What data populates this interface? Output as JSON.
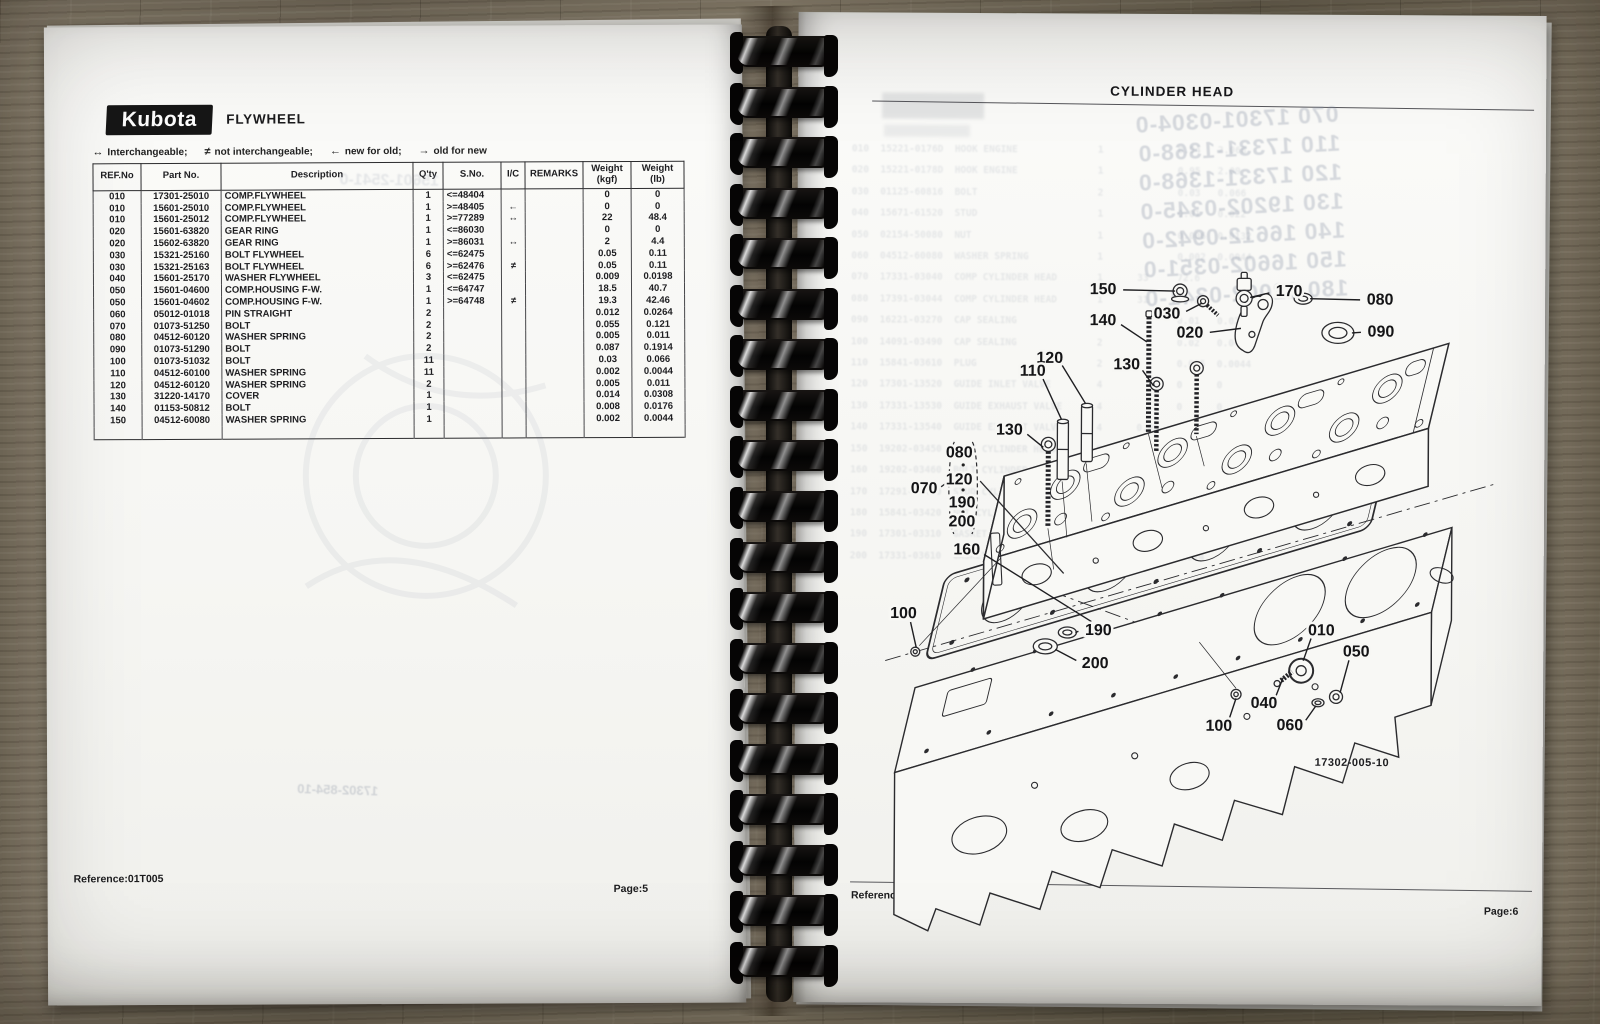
{
  "left_page": {
    "brand_logo": "Kubota",
    "section_title": "FLYWHEEL",
    "legend": [
      {
        "symbol": "↔",
        "label": "Interchangeable;"
      },
      {
        "symbol": "≠",
        "label": "not interchangeable;"
      },
      {
        "symbol": "←",
        "label": "new for old;"
      },
      {
        "symbol": "→",
        "label": "old for new"
      }
    ],
    "table": {
      "headers": [
        "REF.No",
        "Part No.",
        "Description",
        "Q'ty",
        "S.No.",
        "I/C",
        "REMARKS",
        "Weight\n(kgf)",
        "Weight\n(lb)"
      ],
      "rows": [
        [
          "010",
          "17301-25010",
          "COMP.FLYWHEEL",
          "1",
          "<=48404",
          "",
          "",
          "0",
          "0"
        ],
        [
          "010",
          "15601-25010",
          "COMP.FLYWHEEL",
          "1",
          ">=48405",
          "←",
          "",
          "0",
          "0"
        ],
        [
          "010",
          "15601-25012",
          "COMP.FLYWHEEL",
          "1",
          ">=77289",
          "↔",
          "",
          "22",
          "48.4"
        ],
        [
          "020",
          "15601-63820",
          "GEAR RING",
          "1",
          "<=86030",
          "",
          "",
          "0",
          "0"
        ],
        [
          "020",
          "15602-63820",
          "GEAR RING",
          "1",
          ">=86031",
          "↔",
          "",
          "2",
          "4.4"
        ],
        [
          "030",
          "15321-25160",
          "BOLT FLYWHEEL",
          "6",
          "<=62475",
          "",
          "",
          "0.05",
          "0.11"
        ],
        [
          "030",
          "15321-25163",
          "BOLT FLYWHEEL",
          "6",
          ">=62476",
          "≠",
          "",
          "0.05",
          "0.11"
        ],
        [
          "040",
          "15601-25170",
          "WASHER FLYWHEEL",
          "3",
          "<=62475",
          "",
          "",
          "0.009",
          "0.0198"
        ],
        [
          "050",
          "15601-04600",
          "COMP.HOUSING F-W.",
          "1",
          "<=64747",
          "",
          "",
          "18.5",
          "40.7"
        ],
        [
          "050",
          "15601-04602",
          "COMP.HOUSING F-W.",
          "1",
          ">=64748",
          "≠",
          "",
          "19.3",
          "42.46"
        ],
        [
          "060",
          "05012-01018",
          "PIN STRAIGHT",
          "2",
          "",
          "",
          "",
          "0.012",
          "0.0264"
        ],
        [
          "070",
          "01073-51250",
          "BOLT",
          "2",
          "",
          "",
          "",
          "0.055",
          "0.121"
        ],
        [
          "080",
          "04512-60120",
          "WASHER SPRING",
          "2",
          "",
          "",
          "",
          "0.005",
          "0.011"
        ],
        [
          "090",
          "01073-51290",
          "BOLT",
          "2",
          "",
          "",
          "",
          "0.087",
          "0.1914"
        ],
        [
          "100",
          "01073-51032",
          "BOLT",
          "11",
          "",
          "",
          "",
          "0.03",
          "0.066"
        ],
        [
          "110",
          "04512-60100",
          "WASHER SPRING",
          "11",
          "",
          "",
          "",
          "0.002",
          "0.0044"
        ],
        [
          "120",
          "04512-60120",
          "WASHER SPRING",
          "2",
          "",
          "",
          "",
          "0.005",
          "0.011"
        ],
        [
          "130",
          "31220-14170",
          "COVER",
          "1",
          "",
          "",
          "",
          "0.014",
          "0.0308"
        ],
        [
          "140",
          "01153-50812",
          "BOLT",
          "1",
          "",
          "",
          "",
          "0.008",
          "0.0176"
        ],
        [
          "150",
          "04512-60080",
          "WASHER SPRING",
          "1",
          "",
          "",
          "",
          "0.002",
          "0.0044"
        ]
      ]
    },
    "footer": {
      "reference": "Reference:01T005",
      "page": "Page:5"
    },
    "bleed_through": {
      "figure_ghost": "17302-854-10",
      "parts_ghost": "15601-2541-0"
    }
  },
  "right_page": {
    "title": "CYLINDER HEAD",
    "diagram": {
      "figure_id": "17302-005-10",
      "callouts": [
        {
          "label": "150",
          "x": 306,
          "y": 276,
          "ex": 378,
          "ey": 277
        },
        {
          "label": "140",
          "x": 306,
          "y": 307,
          "ex": 350,
          "ey": 328
        },
        {
          "label": "030",
          "x": 370,
          "y": 300,
          "ex": 405,
          "ey": 289
        },
        {
          "label": "020",
          "x": 393,
          "y": 319,
          "ex": 444,
          "ey": 314
        },
        {
          "label": "170",
          "x": 492,
          "y": 277,
          "ex": 453,
          "ey": 283
        },
        {
          "label": "080",
          "x": 583,
          "y": 285,
          "ex": 513,
          "ey": 284
        },
        {
          "label": "090",
          "x": 584,
          "y": 317,
          "ex": 555,
          "ey": 318
        },
        {
          "label": "120",
          "x": 253,
          "y": 345,
          "ex": 289,
          "ey": 390
        },
        {
          "label": "110",
          "x": 236,
          "y": 358,
          "ex": 265,
          "ey": 406
        },
        {
          "label": "130",
          "x": 330,
          "y": 351,
          "ex": 357,
          "ey": 372
        },
        {
          "label": "130",
          "x": 213,
          "y": 417,
          "ex": 247,
          "ey": 434
        },
        {
          "label": "160",
          "x": 171,
          "y": 537,
          "ex": 296,
          "ey": 608
        },
        {
          "label": "100",
          "x": 108,
          "y": 601,
          "ex": 121,
          "ey": 635
        },
        {
          "label": "190",
          "x": 303,
          "y": 617,
          "ex": 280,
          "ey": 619
        },
        {
          "label": "200",
          "x": 300,
          "y": 650,
          "ex": 260,
          "ey": 636
        },
        {
          "label": "010",
          "x": 526,
          "y": 616,
          "ex": 508,
          "ey": 646
        },
        {
          "label": "050",
          "x": 561,
          "y": 637,
          "ex": 545,
          "ey": 678
        },
        {
          "label": "040",
          "x": 469,
          "y": 689,
          "ex": 488,
          "ey": 663
        },
        {
          "label": "100",
          "x": 424,
          "y": 712,
          "ex": 441,
          "ey": 684
        },
        {
          "label": "060",
          "x": 495,
          "y": 711,
          "ex": 521,
          "ey": 691
        }
      ],
      "callout_group": {
        "pointer_label": "070",
        "pointer_x": 128,
        "pointer_y": 476,
        "items": [
          {
            "label": "080",
            "x": 163,
            "y": 440
          },
          {
            "label": "120",
            "x": 163,
            "y": 467
          },
          {
            "label": "190",
            "x": 166,
            "y": 490
          },
          {
            "label": "200",
            "x": 166,
            "y": 509
          }
        ]
      }
    },
    "bleed_through": {
      "stamped_lines": [
        "070 17301-0304-0",
        "110 17331-1368-0",
        "120 17331-1368-0",
        "130 19202-0345-0",
        "140 16612-0942-0",
        "150 16602-0351-0",
        "180 12002-0341-0"
      ],
      "table_lines": [
        "010  15221-0176D  HOOK ENGINE              1             0.94   2.068",
        "020  15221-0178D  HOOK ENGINE              1             0.95   2.09",
        "030  01125-60816  BOLT                     2             0.03   0.066",
        "040  15671-61520  STUD                     1             0.01   0.022",
        "050  02154-50080  NUT                      1             0.006  0.0132",
        "060  04512-60080  WASHER SPRING            1             0.002  0.0044",
        "070  17331-03040  COMP CYLINDER HEAD       1      33     72.6",
        "080  17391-03044  COMP CYLINDER HEAD       1      31     68.2",
        "090  16221-03270  CAP SEALING              8             0.01   0.022",
        "100  14091-03490  CAP SEALING              2             0.02   0.044",
        "110  15841-03610  PLUG                     2             0.005  0.0044",
        "120  17301-13520  GUIDE INLET VALVE        4             0      0",
        "130  17331-13530  GUIDE EXHAUST VALVE      4             0      0",
        "140  17331-13540  GUIDE EXHAUST VALVE      4      0.02   0.044",
        "150  19202-03450  BOLT CYLINDER HEAD       9      0.143  0.143",
        "160  19202-03460  BOLT CYLINDER HEAD       9      0.143  0.0104",
        "170  17291-03450  STUD CYLINDER HEAD       5      0.001  0.154",
        "180  15841-03420  NUT CYLINDER HEAD        5      0.013  0.0286",
        "190  17301-03310  GASKET                   1      0.2    0.44",
        "200  17331-03610  GASKET CYLINDER HEAD     1      0.17   0.374"
      ],
      "figure_ghost": "17302-005-10"
    },
    "footer": {
      "reference": "Reference:01T006",
      "page": "Page:6"
    }
  }
}
